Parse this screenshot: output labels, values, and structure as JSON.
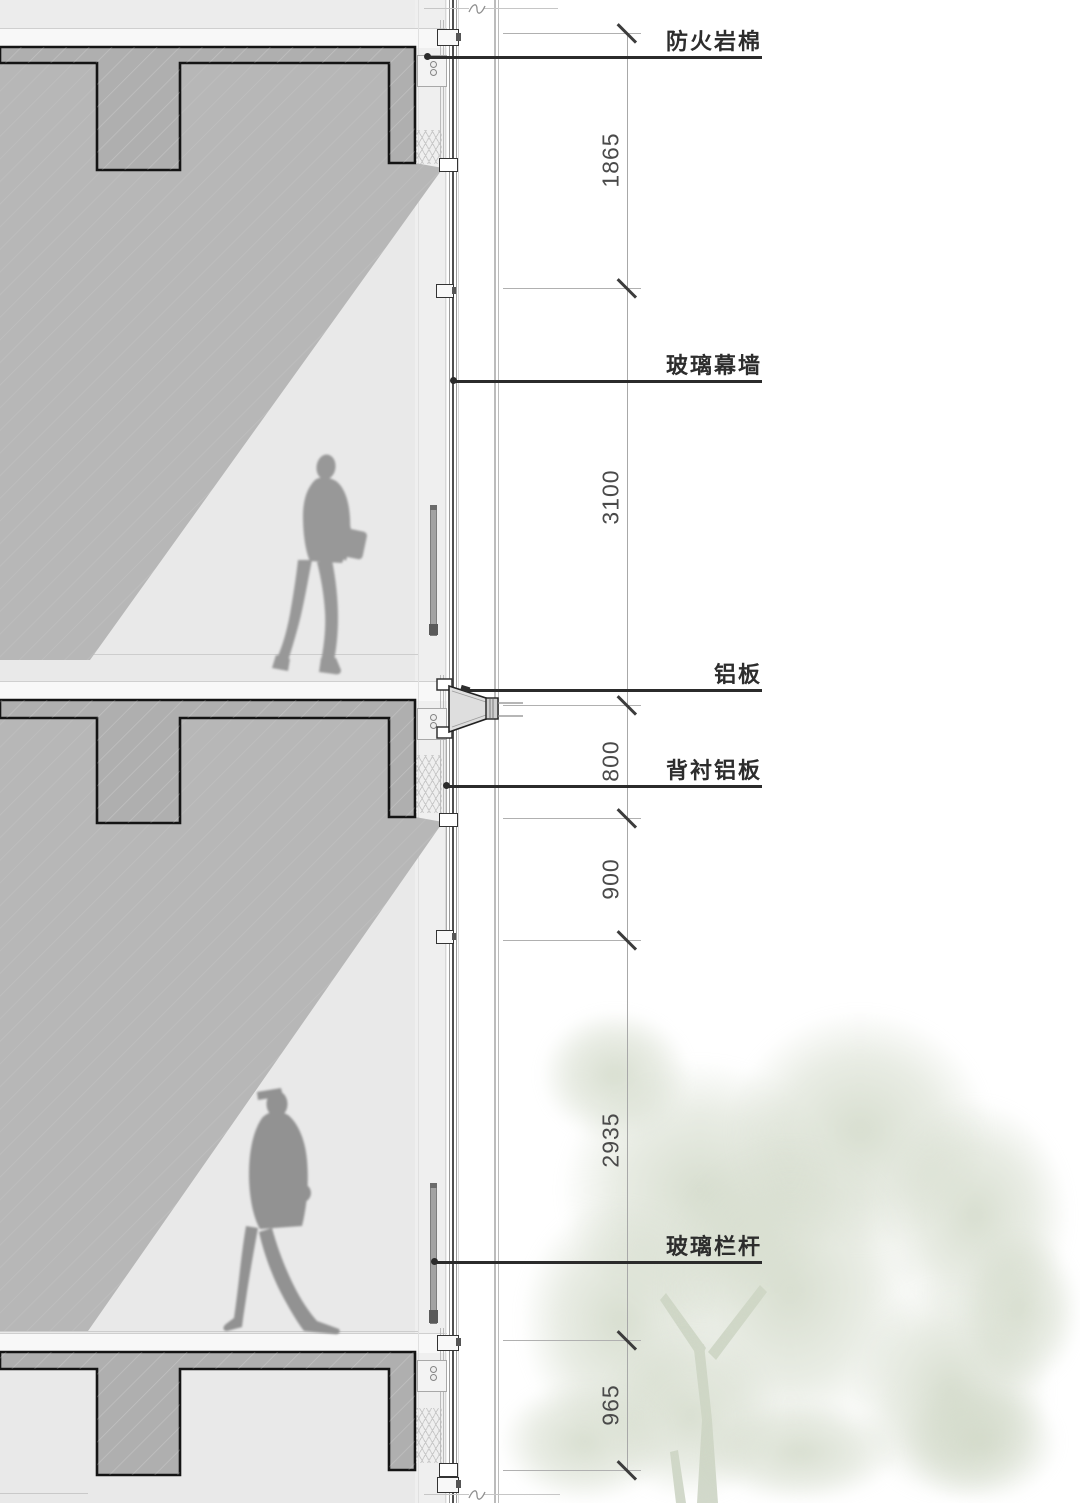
{
  "annotations": {
    "labels": [
      {
        "text": "防火岩棉"
      },
      {
        "text": "玻璃幕墙"
      },
      {
        "text": "铝板"
      },
      {
        "text": "背衬铝板"
      },
      {
        "text": "玻璃栏杆"
      }
    ],
    "dimensions": [
      {
        "value": "1865"
      },
      {
        "value": "3100"
      },
      {
        "value": "800"
      },
      {
        "value": "900"
      },
      {
        "value": "2935"
      },
      {
        "value": "965"
      }
    ]
  },
  "figures": {
    "upper_person": "woman-walking-silhouette",
    "lower_person": "man-walking-cap-silhouette",
    "tree": "tree-silhouette"
  },
  "colors": {
    "concrete_fill": "#afafaf",
    "shadow_fill": "#b7b7b7",
    "interior_fill": "#e9e9e9",
    "outline_ink": "#111111",
    "label_ink": "#2d2d2d",
    "dimension_ink": "#4a4a4a",
    "dimension_line": "#a8a8a8",
    "tree_foliage": "#ced6c4",
    "person_gray": "#979797"
  }
}
